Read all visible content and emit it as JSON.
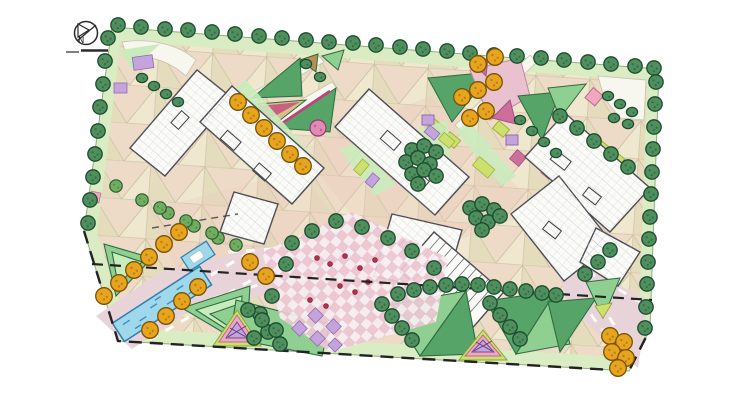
{
  "north_arrow": {
    "label": "N"
  },
  "palette": {
    "background": "#ffffff",
    "perimeter_lawn": "#d9ecc3",
    "paving_base": "#ebe4c9",
    "paving_pink": "#f0cfc6",
    "paving_tan": "#efe8cf",
    "road_pink": "#e8d4d8",
    "path_white": "#f7f6ef",
    "tree_green": "#4e8f5e",
    "tree_light": "#6fae5e",
    "tree_orange": "#e6a41f",
    "flower_pink": "#e08ab4",
    "lawn_light": "#c9ecbd",
    "lawn_mid": "#8fcf92",
    "lawn_dark": "#57a468",
    "chartreuse": "#cde06e",
    "accent_purple": "#c5a3dc",
    "accent_magenta": "#cc6f9e",
    "accent_pink": "#f0a8c0",
    "berry_red": "#b5314e",
    "pool_blue": "#9fd8ea",
    "pool_wave": "#3e8fc0",
    "building_fill": "#fbfbf8",
    "building_line": "#4b4b54",
    "boundary_line": "#222222"
  }
}
